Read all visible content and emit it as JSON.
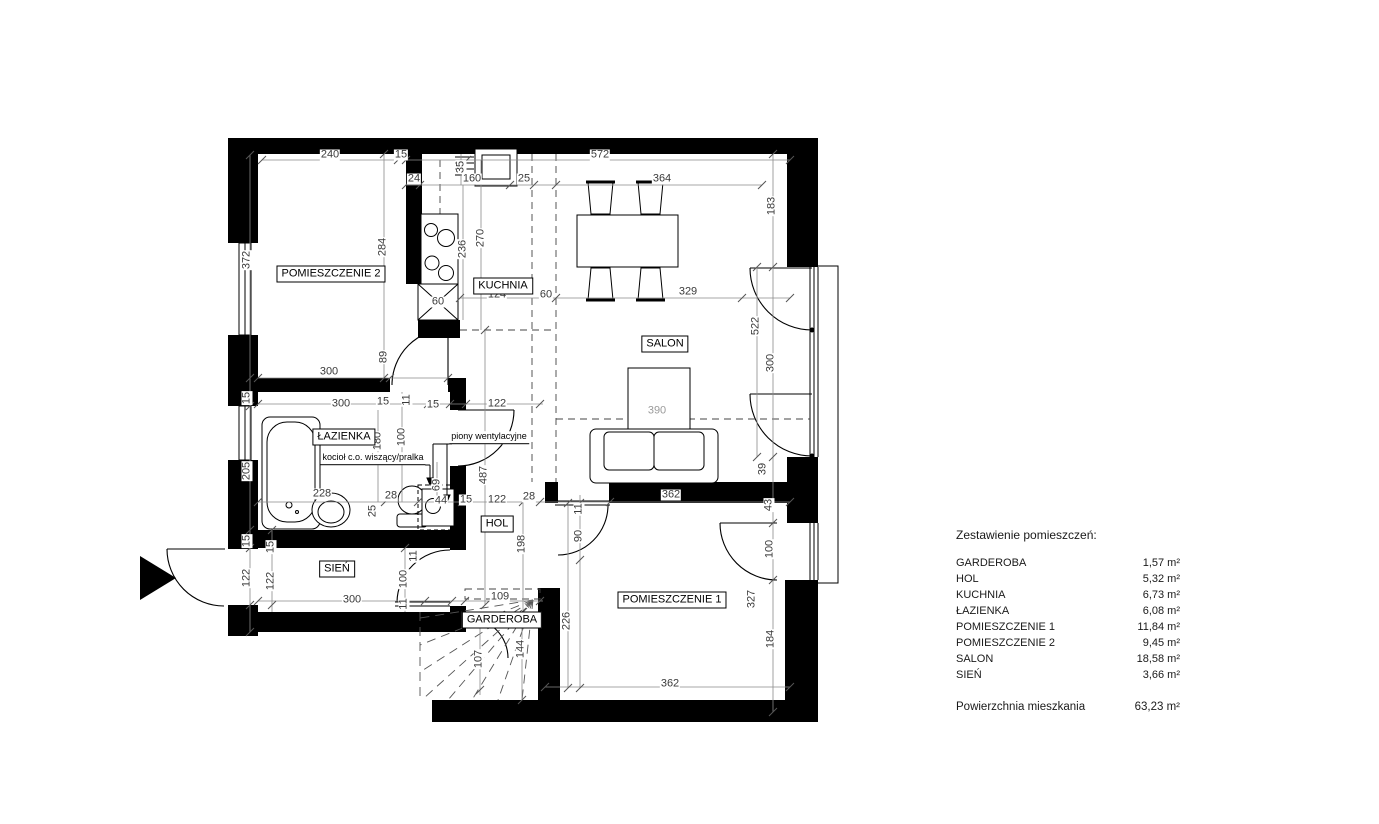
{
  "plan": {
    "colors": {
      "wall": "#000000",
      "thin_line": "#000000",
      "dimension_line": "#8a8a8a",
      "dimension_text": "#3a3a3a",
      "muted_dimension_text": "#9a9a9a",
      "background": "#ffffff"
    },
    "room_labels": [
      {
        "text": "POMIESZCZENIE 2",
        "x": 331,
        "y": 274
      },
      {
        "text": "KUCHNIA",
        "x": 503,
        "y": 286
      },
      {
        "text": "SALON",
        "x": 665,
        "y": 344
      },
      {
        "text": "ŁAZIENKA",
        "x": 344,
        "y": 437
      },
      {
        "text": "HOL",
        "x": 497,
        "y": 524
      },
      {
        "text": "SIEŃ",
        "x": 337,
        "y": 569
      },
      {
        "text": "GARDEROBA",
        "x": 502,
        "y": 620
      },
      {
        "text": "POMIESZCZENIE 1",
        "x": 672,
        "y": 600
      }
    ],
    "annotations": [
      {
        "text": "piony wentylacyjne",
        "x": 489,
        "y": 444
      },
      {
        "text": "kocioł c.o. wiszący/pralka",
        "x": 373,
        "y": 465
      }
    ],
    "dimensions": [
      {
        "t": "240",
        "x": 330,
        "y": 155
      },
      {
        "t": "15",
        "x": 401,
        "y": 155
      },
      {
        "t": "572",
        "x": 600,
        "y": 155
      },
      {
        "t": "24",
        "x": 414,
        "y": 179
      },
      {
        "t": "160",
        "x": 472,
        "y": 179
      },
      {
        "t": "25",
        "x": 524,
        "y": 179
      },
      {
        "t": "364",
        "x": 662,
        "y": 179
      },
      {
        "t": "35",
        "x": 461,
        "y": 167,
        "r": 1
      },
      {
        "t": "372",
        "x": 247,
        "y": 260,
        "r": 1
      },
      {
        "t": "284",
        "x": 383,
        "y": 247,
        "r": 1
      },
      {
        "t": "89",
        "x": 384,
        "y": 357,
        "r": 1
      },
      {
        "t": "300",
        "x": 329,
        "y": 372
      },
      {
        "t": "236",
        "x": 463,
        "y": 249,
        "r": 1
      },
      {
        "t": "270",
        "x": 481,
        "y": 238,
        "r": 1
      },
      {
        "t": "124",
        "x": 497,
        "y": 295
      },
      {
        "t": "60",
        "x": 546,
        "y": 295
      },
      {
        "t": "60",
        "x": 438,
        "y": 302
      },
      {
        "t": "329",
        "x": 688,
        "y": 292
      },
      {
        "t": "183",
        "x": 772,
        "y": 206,
        "r": 1
      },
      {
        "t": "522",
        "x": 756,
        "y": 326,
        "r": 1
      },
      {
        "t": "300",
        "x": 771,
        "y": 363,
        "r": 1
      },
      {
        "t": "390",
        "x": 657,
        "y": 411,
        "muted": 1
      },
      {
        "t": "362",
        "x": 671,
        "y": 495
      },
      {
        "t": "39",
        "x": 763,
        "y": 469,
        "r": 1
      },
      {
        "t": "43",
        "x": 769,
        "y": 505,
        "r": 1
      },
      {
        "t": "100",
        "x": 770,
        "y": 549,
        "r": 1
      },
      {
        "t": "327",
        "x": 752,
        "y": 599,
        "r": 1
      },
      {
        "t": "184",
        "x": 771,
        "y": 639,
        "r": 1
      },
      {
        "t": "362",
        "x": 670,
        "y": 684
      },
      {
        "t": "300",
        "x": 341,
        "y": 404
      },
      {
        "t": "15",
        "x": 383,
        "y": 402
      },
      {
        "t": "11",
        "x": 407,
        "y": 400,
        "r": 1
      },
      {
        "t": "15",
        "x": 433,
        "y": 405
      },
      {
        "t": "122",
        "x": 497,
        "y": 404
      },
      {
        "t": "180",
        "x": 378,
        "y": 441,
        "r": 1
      },
      {
        "t": "100",
        "x": 402,
        "y": 437,
        "r": 1
      },
      {
        "t": "487",
        "x": 484,
        "y": 475,
        "r": 1
      },
      {
        "t": "15",
        "x": 247,
        "y": 398,
        "r": 1
      },
      {
        "t": "205",
        "x": 247,
        "y": 471,
        "r": 1
      },
      {
        "t": "15",
        "x": 247,
        "y": 541,
        "r": 1
      },
      {
        "t": "122",
        "x": 247,
        "y": 578,
        "r": 1
      },
      {
        "t": "228",
        "x": 322,
        "y": 494
      },
      {
        "t": "28",
        "x": 391,
        "y": 496
      },
      {
        "t": "25",
        "x": 373,
        "y": 511,
        "r": 1
      },
      {
        "t": "69",
        "x": 437,
        "y": 485,
        "r": 1
      },
      {
        "t": "44",
        "x": 441,
        "y": 501
      },
      {
        "t": "15",
        "x": 466,
        "y": 500
      },
      {
        "t": "122",
        "x": 497,
        "y": 500
      },
      {
        "t": "28",
        "x": 529,
        "y": 497
      },
      {
        "t": "198",
        "x": 522,
        "y": 544,
        "r": 1
      },
      {
        "t": "90",
        "x": 579,
        "y": 536,
        "r": 1
      },
      {
        "t": "11",
        "x": 579,
        "y": 509,
        "r": 1
      },
      {
        "t": "15",
        "x": 271,
        "y": 547,
        "r": 1
      },
      {
        "t": "122",
        "x": 271,
        "y": 581,
        "r": 1
      },
      {
        "t": "300",
        "x": 352,
        "y": 600
      },
      {
        "t": "100",
        "x": 404,
        "y": 579,
        "r": 1
      },
      {
        "t": "11",
        "x": 404,
        "y": 604,
        "r": 1
      },
      {
        "t": "11",
        "x": 414,
        "y": 556,
        "r": 1
      },
      {
        "t": "109",
        "x": 500,
        "y": 597
      },
      {
        "t": "144",
        "x": 521,
        "y": 649,
        "r": 1
      },
      {
        "t": "107",
        "x": 479,
        "y": 659,
        "r": 1
      },
      {
        "t": "226",
        "x": 567,
        "y": 621,
        "r": 1
      }
    ],
    "legend": {
      "title": "Zestawienie pomieszczeń:",
      "items": [
        {
          "label": "GARDEROBA",
          "value": "1,57 m²"
        },
        {
          "label": "HOL",
          "value": "5,32 m²"
        },
        {
          "label": "KUCHNIA",
          "value": "6,73 m²"
        },
        {
          "label": "ŁAZIENKA",
          "value": "6,08 m²"
        },
        {
          "label": "POMIESZCZENIE 1",
          "value": "11,84 m²"
        },
        {
          "label": "POMIESZCZENIE 2",
          "value": "9,45 m²"
        },
        {
          "label": "SALON",
          "value": "18,58 m²"
        },
        {
          "label": "SIEŃ",
          "value": "3,66 m²"
        }
      ],
      "total_label": "Powierzchnia mieszkania",
      "total_value": "63,23 m²"
    }
  }
}
